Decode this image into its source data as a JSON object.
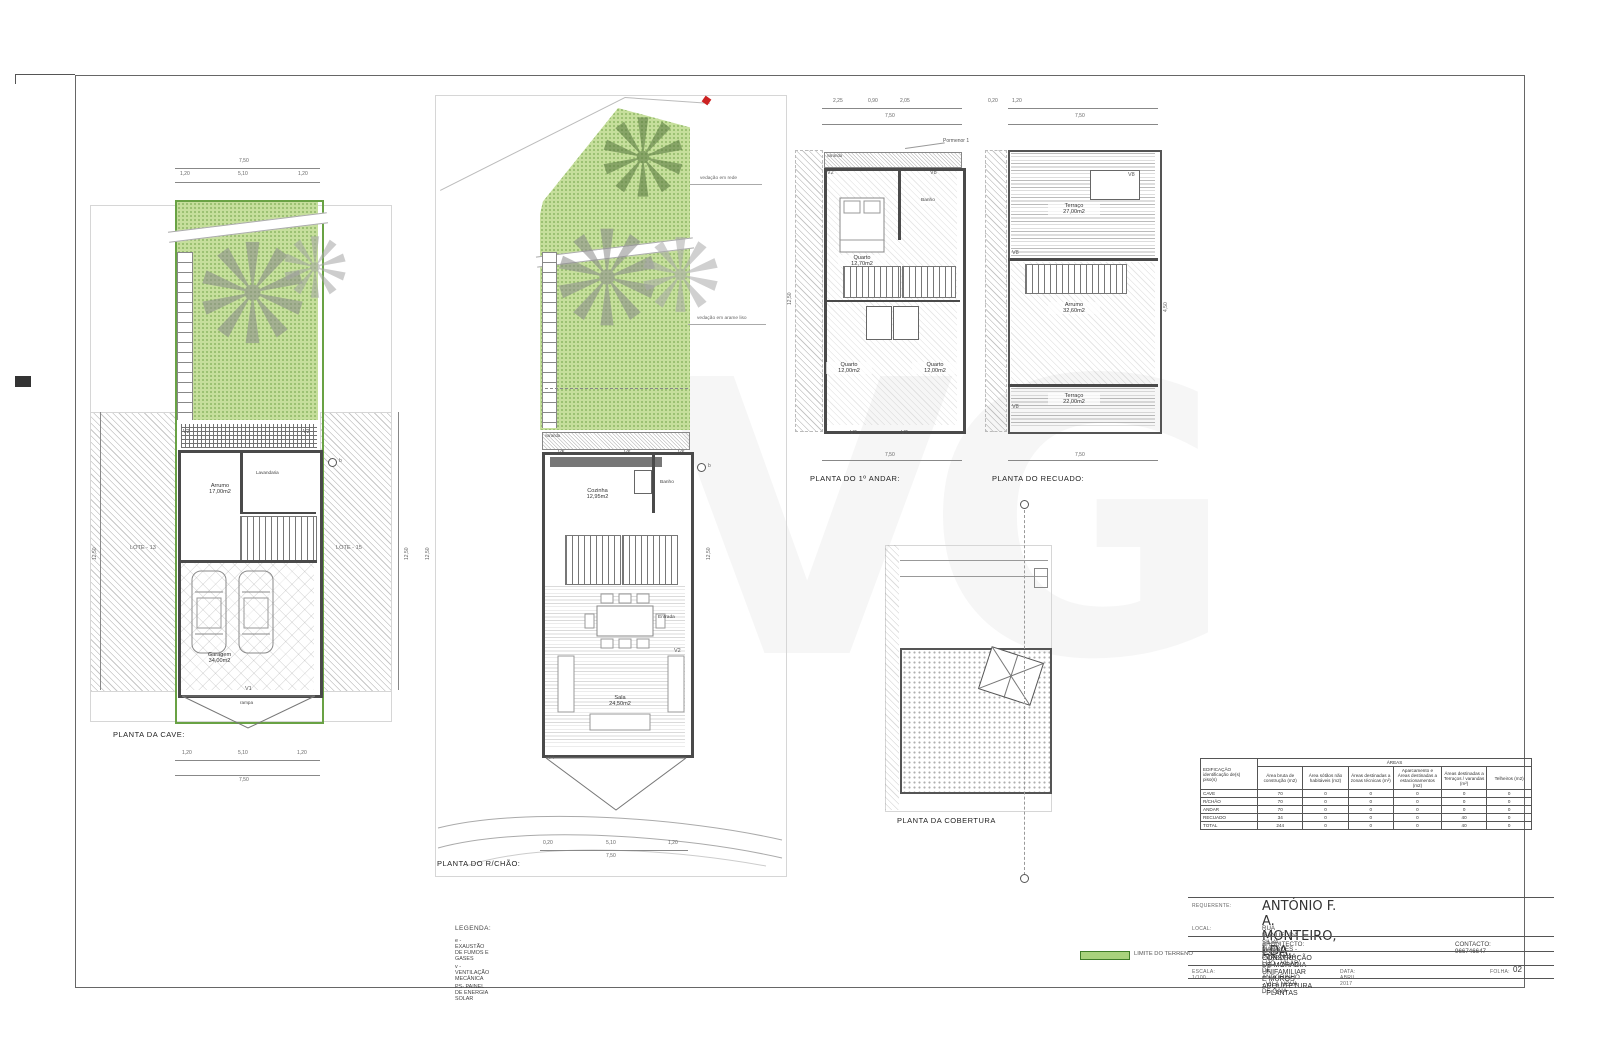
{
  "sheet": {
    "watermark": "VG"
  },
  "notes": {
    "fence_top": "vedação em rede",
    "fence_bottom": "vedação em arame liso",
    "pormenor": "Pormenor 1",
    "rampa": "rampa",
    "varanda": "varanda",
    "marker": "b"
  },
  "windows": {
    "v1": "V1",
    "v2": "V2",
    "v3": "V3",
    "v4": "V4",
    "v5": "V5",
    "v6": "V6",
    "v7": "V7",
    "v8": "V8"
  },
  "lotes": {
    "left": "LOTE - 13",
    "right": "LOTE - 15"
  },
  "dims": {
    "d750": "7,50",
    "d1250": "12,50",
    "d510": "5,10",
    "d120": "1,20",
    "d020": "0,20",
    "d450": "4,50",
    "d225": "2,25",
    "d090": "0,90",
    "d205": "2,05"
  },
  "plans": {
    "cave": {
      "title": "PLANTA DA CAVE:",
      "rooms": {
        "arrumo": {
          "name": "Arrumo",
          "area": "17,00m2"
        },
        "lavandaria": {
          "name": "Lavandaria"
        },
        "garagem": {
          "name": "Garagem",
          "area": "34,00m2"
        }
      }
    },
    "rchao": {
      "title": "PLANTA DO R/CHÃO:",
      "rooms": {
        "cozinha": {
          "name": "Cozinha",
          "area": "12,95m2"
        },
        "banho": {
          "name": "Banho"
        },
        "sala": {
          "name": "Sala",
          "area": "24,50m2"
        },
        "entrada": {
          "name": "Entrada"
        }
      }
    },
    "andar": {
      "title": "PLANTA DO 1º ANDAR:",
      "rooms": {
        "quarto1": {
          "name": "Quarto",
          "area": "12,70m2"
        },
        "banho": {
          "name": "Banho"
        },
        "quarto2": {
          "name": "Quarto",
          "area": "12,00m2"
        },
        "quarto3": {
          "name": "Quarto",
          "area": "12,00m2"
        }
      }
    },
    "recuado": {
      "title": "PLANTA DO RECUADO:",
      "rooms": {
        "terraco_top": {
          "name": "Terraço",
          "area": "27,00m2"
        },
        "arrumo": {
          "name": "Arrumo",
          "area": "32,60m2"
        },
        "terraco_bottom": {
          "name": "Terraço",
          "area": "22,00m2"
        }
      }
    },
    "cobertura": {
      "title": "PLANTA DA COBERTURA"
    }
  },
  "areas_table": {
    "title": "ÁREAS",
    "row_header": "EDIFICAÇÃO identificação de(s) piso(s)",
    "columns": [
      "Área bruta de construção (m2)",
      "Área sótãos não habitáveis (m2)",
      "Áreas destinadas a zonas técnicas (m²)",
      "Aparcamento e Áreas destinadas a estacionamentos (m2)",
      "Áreas destinadas a Terraços / varandas (m²)",
      "Telheiros (m2)"
    ],
    "rows": [
      {
        "label": "CAVE",
        "values": [
          "70",
          "0",
          "0",
          "0",
          "0",
          "0"
        ]
      },
      {
        "label": "R/CHÃO",
        "values": [
          "70",
          "0",
          "0",
          "0",
          "0",
          "0"
        ]
      },
      {
        "label": "ANDAR",
        "values": [
          "70",
          "0",
          "0",
          "0",
          "0",
          "0"
        ]
      },
      {
        "label": "RECUADO",
        "values": [
          "34",
          "0",
          "0",
          "0",
          "40",
          "0"
        ]
      },
      {
        "label": "TOTAL",
        "values": [
          "244",
          "0",
          "0",
          "0",
          "40",
          "0"
        ]
      }
    ]
  },
  "legend": {
    "title": "LEGENDA:",
    "items": [
      "e - EXAUSTÃO DE FUMOS E GASES",
      "v - VENTILAÇÃO MECÂNICA",
      "PS- PAINEL DE ENERGIA SOLAR"
    ],
    "limite": "LIMITE DO TERRENO"
  },
  "title_block": {
    "requerente_label": "REQUERENTE:",
    "requerente": "ANTÓNIO F. A. MONTEIRO, LDA.",
    "local_label": "LOCAL:",
    "local": "RUA MANUEL DA SILVA MARQUES - LOTE Nº 14 - LIJÓ - VILAR DE ANDORINHO - VILA NOVA DE GAIA",
    "arquitecto": "ARQUITECTO: ANÍBAL CARDOSO",
    "contacto": "CONTACTO: 966746647",
    "obra": "CONSTRUÇÃO DE MORADIA UNIFAMILIAR E MUROS - ARQUITETURA - PLANTAS",
    "escala": "ESCALA: 1/100",
    "data": "DATA: ABRIL 2017",
    "folha_label": "FOLHA:",
    "folha": "02"
  },
  "colors": {
    "terrain_green": "#c6df9c",
    "terrain_border": "#69a244",
    "line": "#4a4a4a",
    "red_mark": "#cc2222"
  }
}
